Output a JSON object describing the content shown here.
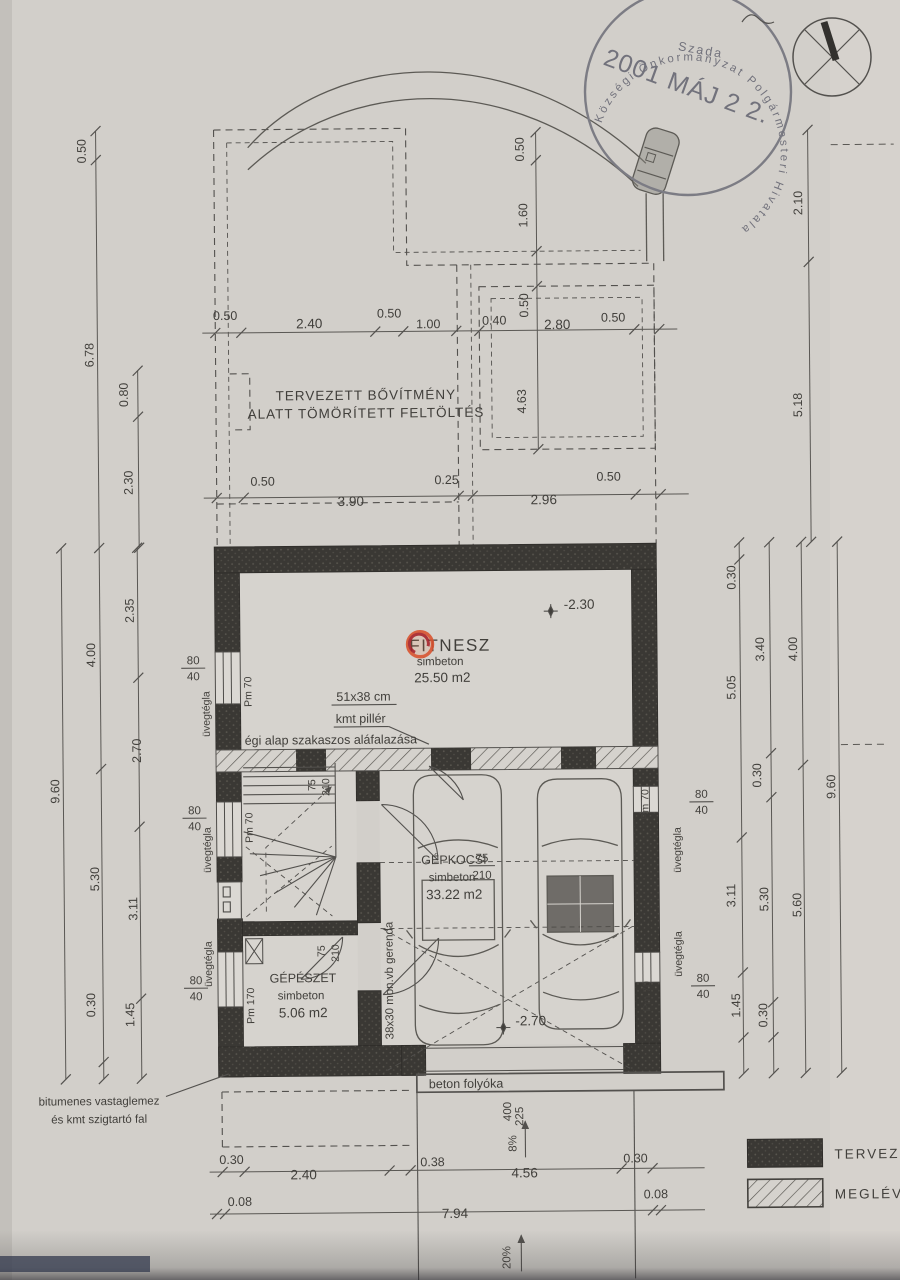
{
  "stamp": {
    "ring_text": "Községi Önkormányzat Polgármesteri Hivatala",
    "place": "Szada",
    "date": "2001 MÁJ 2 2."
  },
  "title_note": {
    "line1": "TERVEZETT BŐVÍTMÉNY",
    "line2": "ALATT TÖMÖRÍTETT FELTÖLTÉS"
  },
  "rooms": {
    "hobby": {
      "name": "FITNESZ",
      "floor": "simbeton",
      "area": "25.50 m2",
      "level": "-2.30"
    },
    "garage": {
      "name": "GÉPKOCSI",
      "floor": "simbeton",
      "area": "33.22 m2",
      "level": "-2.70"
    },
    "mech": {
      "name": "GÉPÉSZET",
      "floor": "simbeton",
      "area": "5.06 m2"
    }
  },
  "annotations": {
    "pillar_size": "51x38 cm",
    "pillar_name": "kmt pillér",
    "underpinning": "égi alap szakaszos aláfalazása",
    "beam": "38x30 mon.vb gerenda",
    "waterproof1": "bitumenes vastaglemez",
    "waterproof2": "és kmt szigtartó fal",
    "drain": "beton folyóka",
    "ramp_slope": "8%",
    "road_slope": "20%"
  },
  "wall_labels": {
    "w80": "80",
    "w40": "40",
    "pm70": "Pm 70",
    "pm170": "Pm 170",
    "glassblock": "üvegtégla",
    "d75": "75",
    "d210": "210"
  },
  "legend": {
    "planned": "TERVEZETT",
    "existing": "MEGLÉVŐ"
  },
  "dims": {
    "top_row": [
      "0.50",
      "2.40",
      "0.50",
      "1.00",
      "0.40",
      "2.80",
      "0.50"
    ],
    "top_vertical": [
      "0.50",
      "1.60",
      "0.50",
      "4.63"
    ],
    "mid_row": [
      "0.50",
      "3.90",
      "0.25",
      "2.96",
      "0.50"
    ],
    "bottom_row": [
      "0.30",
      "2.40",
      "0.38",
      "4.56",
      "0.30"
    ],
    "total_row": [
      "0.08",
      "7.94",
      "0.08"
    ],
    "left_top": [
      "0.50",
      "6.78"
    ],
    "left_step": [
      "0.80",
      "2.30"
    ],
    "left_total": "9.60",
    "left_mid": [
      "4.00",
      "5.30",
      "0.30"
    ],
    "left_inner": [
      "2.35",
      "2.70",
      "3.11",
      "1.45"
    ],
    "right_top": [
      "2.10",
      "5.18"
    ],
    "right_inner": [
      "0.30",
      "5.05",
      "3.11",
      "1.45"
    ],
    "right_mid": [
      "3.40",
      "0.30",
      "5.30",
      "0.30"
    ],
    "right_outer": [
      "4.00",
      "5.60"
    ],
    "right_total": "9.60",
    "drain": [
      "400",
      "225"
    ]
  }
}
